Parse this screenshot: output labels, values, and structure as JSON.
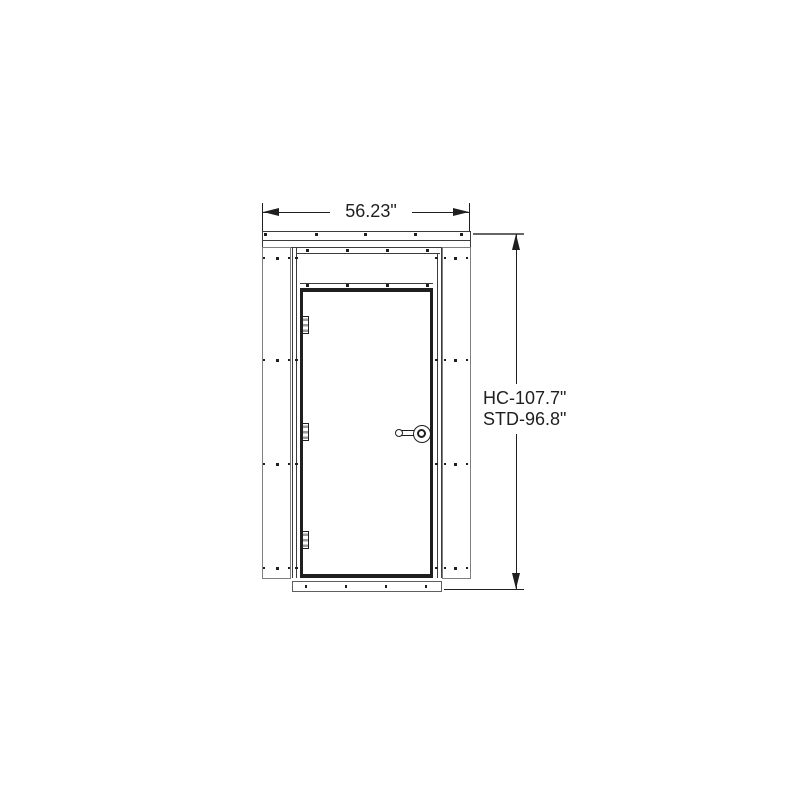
{
  "dimensions": {
    "width_label": "56.23\"",
    "height_label_line1": "HC-107.7\"",
    "height_label_line2": "STD-96.8\""
  },
  "colors": {
    "background": "#ffffff",
    "line": "#1f1f1f",
    "frame": "#3c3c3c",
    "panel": "#7f7f7f",
    "sill": "#5f5f5f"
  },
  "drawing": {
    "hinge_x": 302,
    "hinge_w": 6.5,
    "hinge_h": 18,
    "hinges_y": [
      316,
      423,
      531
    ],
    "fasteners": [
      [
        265.5,
        234.5,
        3
      ],
      [
        316,
        234.5,
        3
      ],
      [
        365.5,
        234.5,
        3
      ],
      [
        415,
        234.5,
        3
      ],
      [
        461,
        234.5,
        3
      ],
      [
        307,
        250.5,
        3
      ],
      [
        347,
        250.5,
        3
      ],
      [
        387,
        250.5,
        3
      ],
      [
        427,
        250.5,
        3
      ],
      [
        307,
        285.5,
        3
      ],
      [
        347,
        285.5,
        3
      ],
      [
        387,
        285.5,
        3
      ],
      [
        427,
        285.5,
        3
      ],
      [
        264,
        258,
        2
      ],
      [
        277.5,
        258,
        3
      ],
      [
        288.5,
        258,
        2
      ],
      [
        296.5,
        258,
        2.5
      ],
      [
        436.5,
        258,
        2.5
      ],
      [
        444.5,
        258,
        2
      ],
      [
        455.5,
        258,
        3
      ],
      [
        466.5,
        258,
        2
      ],
      [
        264,
        360,
        2
      ],
      [
        277.5,
        360,
        3
      ],
      [
        288.5,
        360,
        2
      ],
      [
        296.5,
        360,
        2.5
      ],
      [
        436.5,
        360,
        2.5
      ],
      [
        444.5,
        360,
        2
      ],
      [
        455.5,
        360,
        3
      ],
      [
        466.5,
        360,
        2
      ],
      [
        264,
        464,
        2
      ],
      [
        277.5,
        464,
        3
      ],
      [
        288.5,
        464,
        2
      ],
      [
        296.5,
        464,
        2.5
      ],
      [
        436.5,
        464,
        2.5
      ],
      [
        444.5,
        464,
        2
      ],
      [
        455.5,
        464,
        3
      ],
      [
        466.5,
        464,
        2
      ],
      [
        264,
        568,
        2
      ],
      [
        277.5,
        568,
        3
      ],
      [
        288.5,
        568,
        2
      ],
      [
        296.5,
        568,
        2.5
      ],
      [
        436.5,
        568,
        2.5
      ],
      [
        444.5,
        568,
        2
      ],
      [
        455.5,
        568,
        3
      ],
      [
        466.5,
        568,
        2
      ],
      [
        306,
        586.5,
        2.5
      ],
      [
        346,
        586.5,
        2.5
      ],
      [
        386,
        586.5,
        2.5
      ],
      [
        426,
        586.5,
        2.5
      ]
    ]
  }
}
